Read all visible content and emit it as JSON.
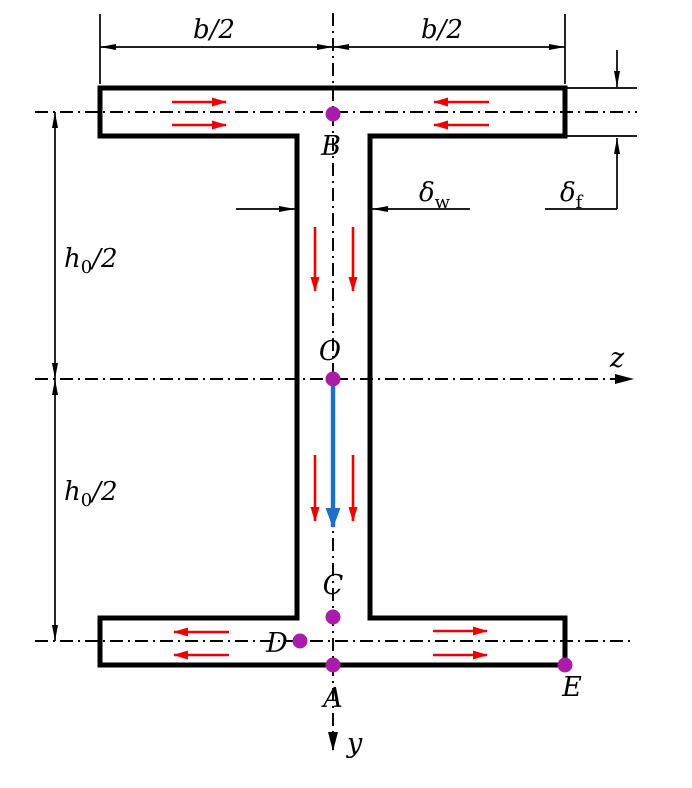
{
  "labels": {
    "dim_b_half_left": "b/2",
    "dim_b_half_right": "b/2",
    "dim_h0_half_top": {
      "base": "h",
      "sub": "0",
      "rest": "/2"
    },
    "dim_h0_half_bottom": {
      "base": "h",
      "sub": "0",
      "rest": "/2"
    },
    "dim_delta_w": {
      "base": "δ",
      "sub": "w"
    },
    "dim_delta_f": {
      "base": "δ",
      "sub": "f"
    },
    "point_B": "B",
    "point_O": "O",
    "point_C": "C",
    "point_D": "D",
    "point_A": "A",
    "point_E": "E",
    "axis_z": "z",
    "axis_y": "y"
  },
  "colors": {
    "ink": "#000000",
    "shear-arrow": "#ee0000",
    "resultant-arrow": "#1f6fc8",
    "point-marker": "#aa1caa"
  }
}
